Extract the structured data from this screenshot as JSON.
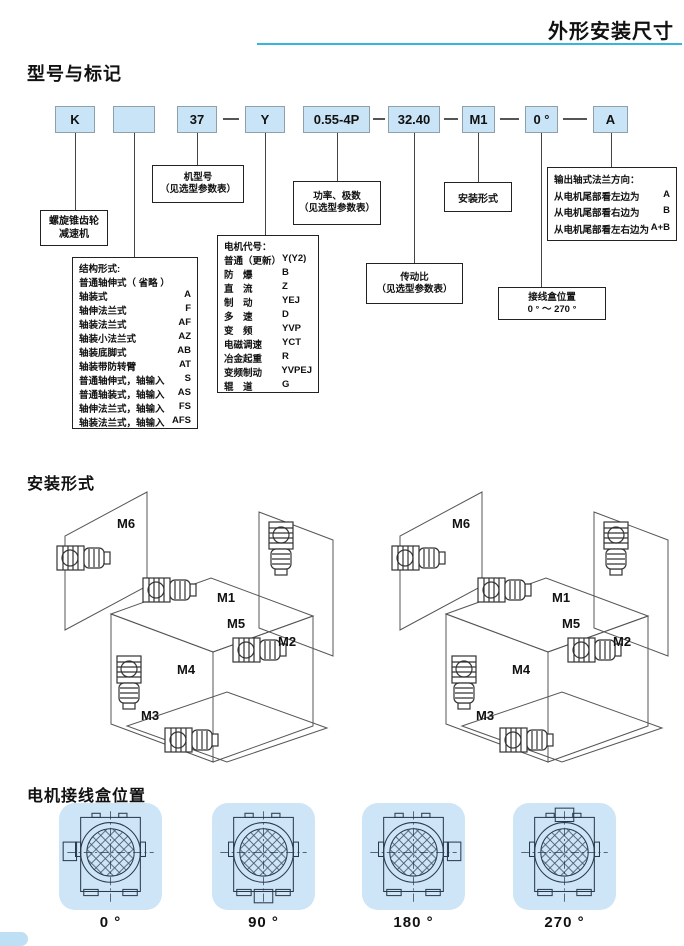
{
  "header": {
    "title": "外形安装尺寸"
  },
  "sections": {
    "model": "型号与标记",
    "mounting": "安装形式",
    "junction": "电机接线盒位置"
  },
  "model_code": {
    "boxes": [
      "K",
      "",
      "37",
      "Y",
      "0.55-4P",
      "32.40",
      "M1",
      "0 °",
      "A"
    ],
    "reducer_label": {
      "line1": "螺旋锥齿轮",
      "line2": "减速机"
    },
    "model_number_label": {
      "line1": "机型号",
      "line2": "（见选型参数表）"
    },
    "power_label": {
      "line1": "功率、极数",
      "line2": "（见选型参数表）"
    },
    "ratio_label": {
      "line1": "传动比",
      "line2": "（见选型参数表）"
    },
    "mounting_label": "安装形式",
    "junction_label": {
      "line1": "接线盒位置",
      "line2": "0 ° ～ 270 °"
    },
    "structure": {
      "title": "结构形式:",
      "items": [
        {
          "name": "普通轴伸式（ 省略 ）",
          "code": ""
        },
        {
          "name": "轴装式",
          "code": "A"
        },
        {
          "name": "轴伸法兰式",
          "code": "F"
        },
        {
          "name": "轴装法兰式",
          "code": "AF"
        },
        {
          "name": "轴装小法兰式",
          "code": "AZ"
        },
        {
          "name": "轴装底脚式",
          "code": "AB"
        },
        {
          "name": "轴装带防转臂",
          "code": "AT"
        },
        {
          "name": "普通轴伸式，轴输入",
          "code": "S"
        },
        {
          "name": "普通轴装式，轴输入",
          "code": "AS"
        },
        {
          "name": "轴伸法兰式，轴输入",
          "code": "FS"
        },
        {
          "name": "轴装法兰式，轴输入",
          "code": "AFS"
        }
      ]
    },
    "motor_codes": {
      "title": "电机代号：",
      "items": [
        {
          "name": "普通（更新）",
          "code": "Y(Y2)"
        },
        {
          "name": "防　爆",
          "code": "B"
        },
        {
          "name": "直　流",
          "code": "Z"
        },
        {
          "name": "制　动",
          "code": "YEJ"
        },
        {
          "name": "多　速",
          "code": "D"
        },
        {
          "name": "变　频",
          "code": "YVP"
        },
        {
          "name": "电磁调速",
          "code": "YCT"
        },
        {
          "name": "冶金起重",
          "code": "R"
        },
        {
          "name": "变频制动",
          "code": "YVPEJ"
        },
        {
          "name": "辊　道",
          "code": "G"
        }
      ]
    },
    "flange": {
      "title": "输出轴式法兰方向：",
      "items": [
        {
          "name": "从电机尾部看左边为",
          "code": "A"
        },
        {
          "name": "从电机尾部看右边为",
          "code": "B"
        },
        {
          "name": "从电机尾部看左右边为",
          "code": "A+B"
        }
      ]
    }
  },
  "mounting": {
    "labels": [
      "M1",
      "M2",
      "M3",
      "M4",
      "M5",
      "M6"
    ]
  },
  "junction": {
    "positions": [
      "0 °",
      "90 °",
      "180 °",
      "270 °"
    ]
  },
  "colors": {
    "accent": "#38b6da",
    "code_box_fill": "#c9e4f6",
    "tile_fill": "#cde5f7"
  }
}
